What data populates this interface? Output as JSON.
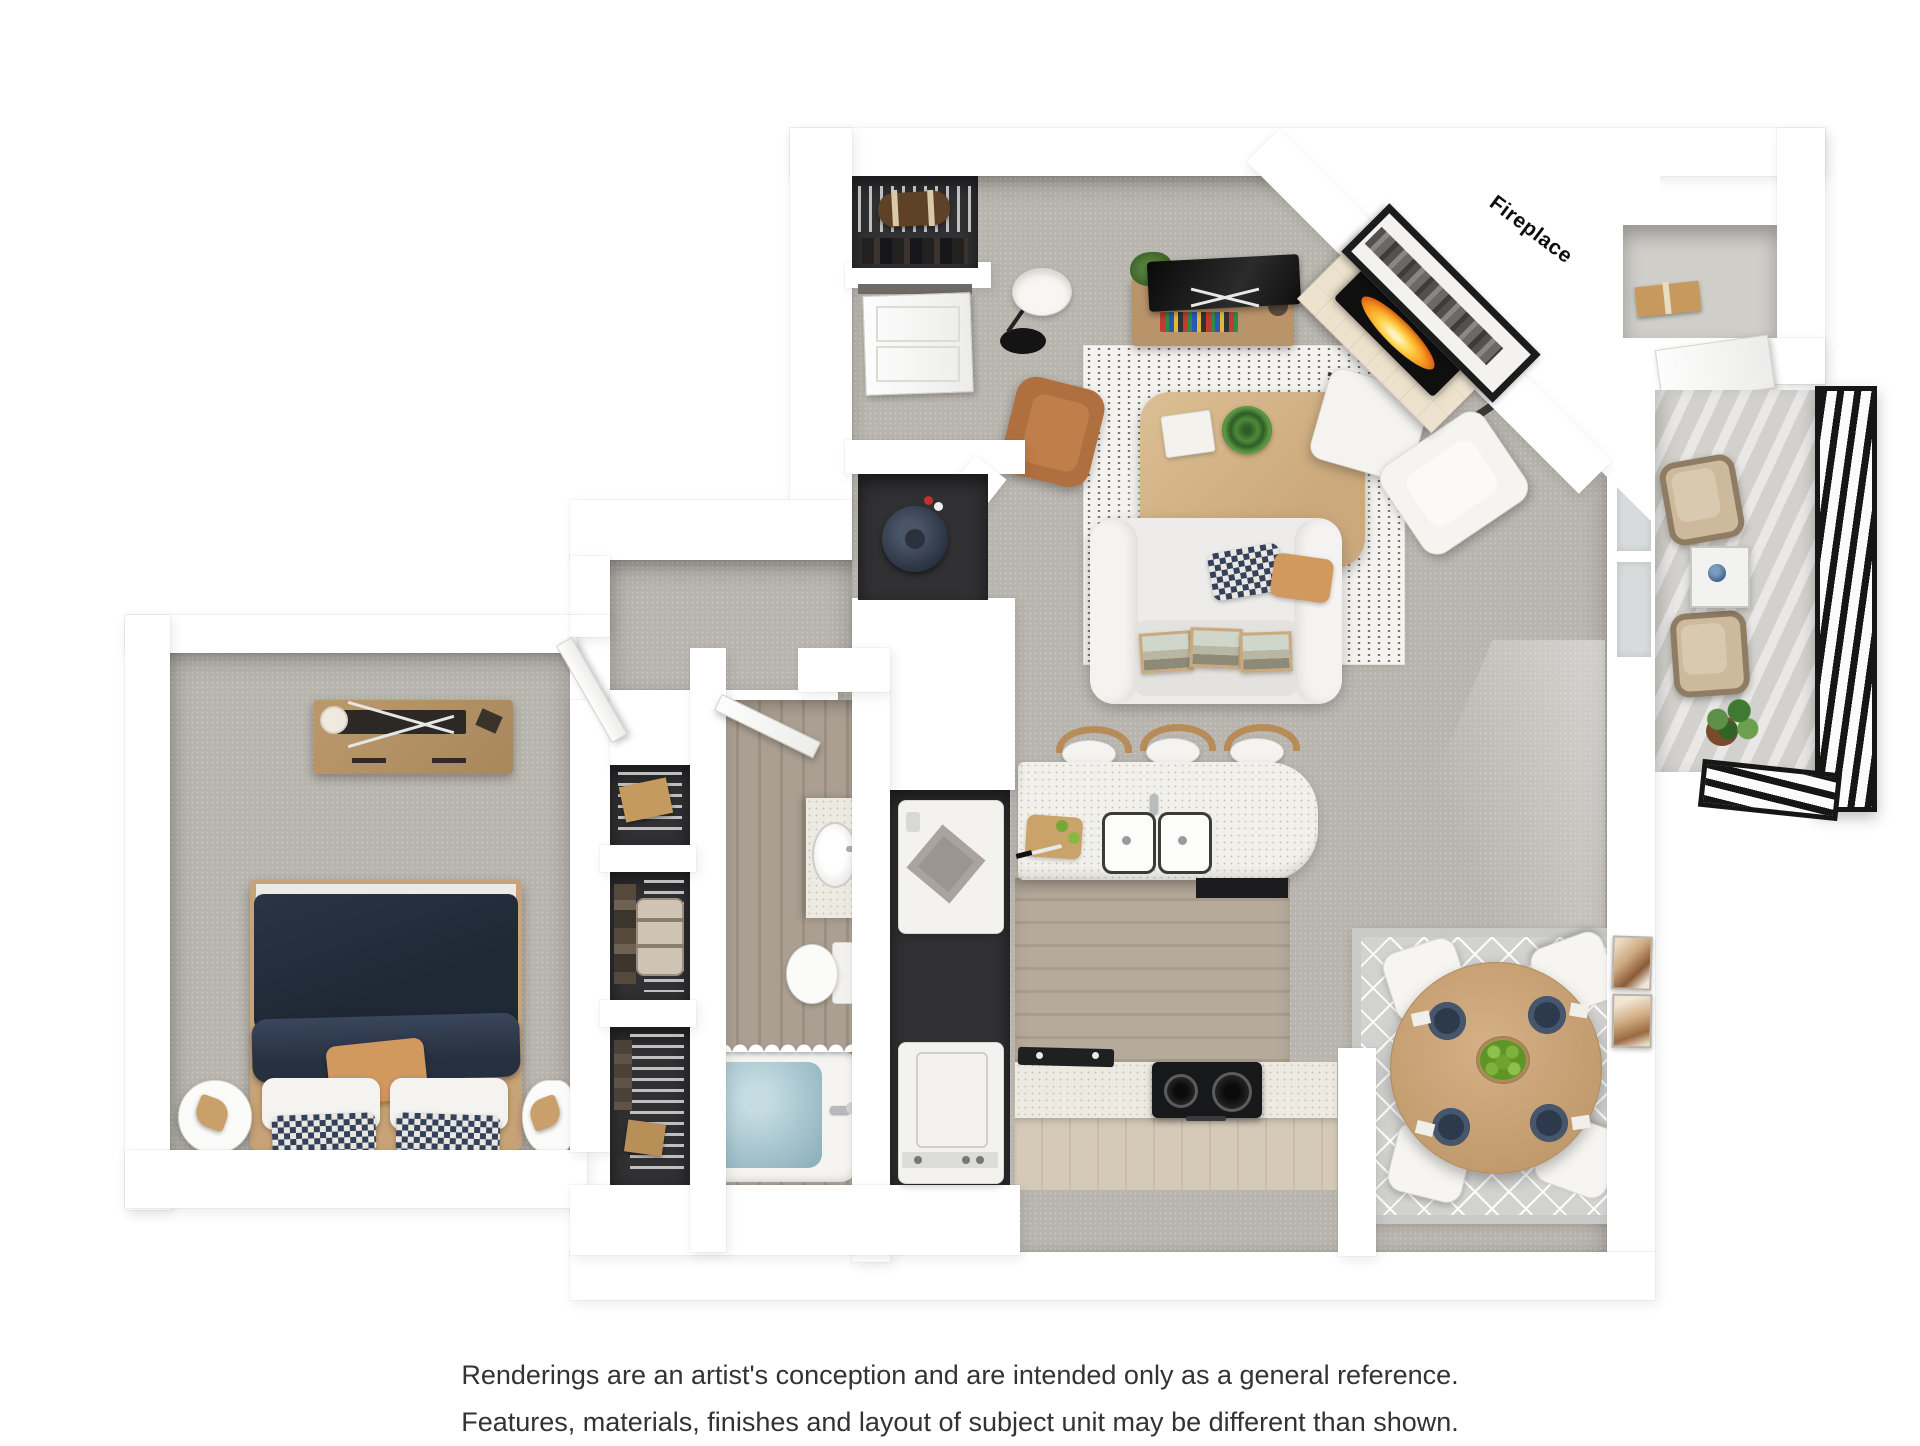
{
  "floorplan": {
    "wall_label": "Fireplace",
    "colors": {
      "wall": "#ffffff",
      "carpet": "#b8b4ae",
      "rug_living": "#f5f3ef",
      "rug_dining": "#d2d2d0",
      "island": "#f2f0ea",
      "cabinet": "#d5cab7",
      "duvet": "#27303d",
      "accent_pillow": "#d2995f",
      "leather": "#b06f3e",
      "wood_furniture": "#c3996c",
      "fire": "#f6991f",
      "railing": "#161616",
      "tub_water": "#a3c2cc",
      "plant": "#5d8f46"
    }
  },
  "disclaimer": {
    "line1": "Renderings are an artist's conception and are intended only as a general reference.",
    "line2": "Features, materials, finishes and layout of subject unit may be different than shown."
  }
}
